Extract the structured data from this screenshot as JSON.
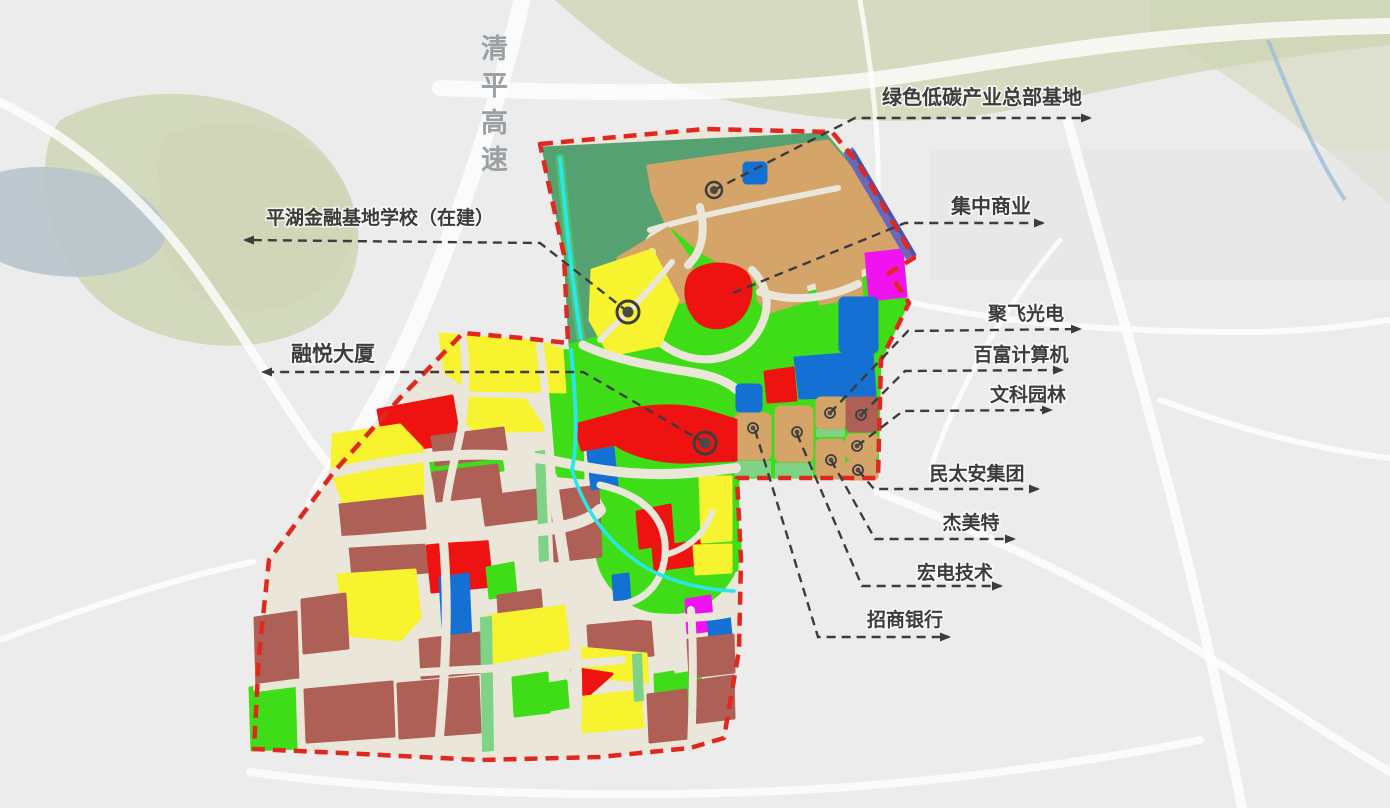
{
  "map_title": "平湖金融基地周边产业规划图",
  "annotations": {
    "expressway": {
      "label": "清平高速"
    },
    "green_base": {
      "label": "绿色低碳产业总部基地"
    },
    "school": {
      "label": "平湖金融基地学校（在建）"
    },
    "commercial": {
      "label": "集中商业"
    },
    "jufei": {
      "label": "聚飞光电"
    },
    "baifu": {
      "label": "百富计算机"
    },
    "wenke": {
      "label": "文科园林"
    },
    "rongyue": {
      "label": "融悦大厦"
    },
    "mintaian": {
      "label": "民太安集团"
    },
    "jiemeite": {
      "label": "杰美特"
    },
    "hongdian": {
      "label": "宏电技术"
    },
    "zhaoshang": {
      "label": "招商银行"
    }
  },
  "colors": {
    "boundary": "#e02820",
    "parkland": "#3fdd18",
    "forest": "#55a171",
    "industrial-tan": "#d4a469",
    "commercial-red": "#ee1311",
    "residential-maroon": "#ae6057",
    "mixed-yellow": "#f7f32e",
    "facility-blue": "#1470d2",
    "special-magenta": "#f013f0",
    "rail-purple": "#6b68b8",
    "water-cyan": "#2be6e9",
    "road-cream": "#eae6da",
    "bg-gray": "#ececec",
    "bg-park": "#cdd4b2",
    "bg-water": "#b9c4cc",
    "label-dark": "#3c3c3c",
    "label-gray": "#9aa0a4"
  }
}
